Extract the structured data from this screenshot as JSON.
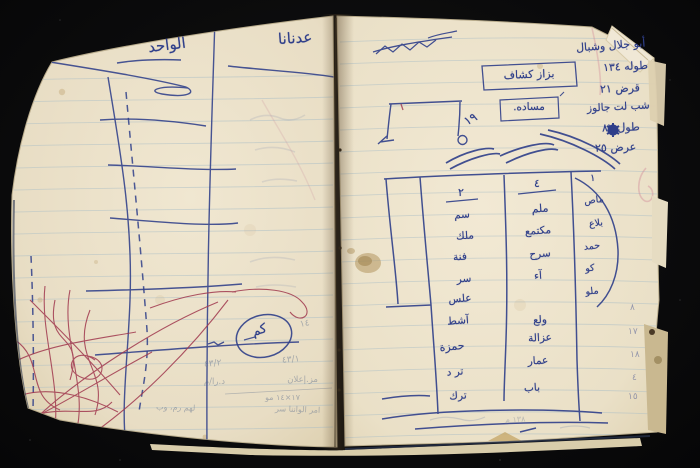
{
  "colors": {
    "background": "#0b0b0c",
    "paper_left": "#e9dfc8",
    "paper_right": "#ece3cc",
    "ruled_line": "#a9bdc6",
    "ink_blue": "#2f3f8a",
    "ink_red": "#a0384e",
    "pencil": "#64748f",
    "cover_edge": "#2a3550"
  },
  "left_page": {
    "header_right": "عدنانا",
    "header_left": "الواحد",
    "circled_word": "كم",
    "side_mark": "١٤",
    "pencil_notes": [
      "٤٣/٢",
      "٤٣/١",
      "د.را/م",
      "مز.إعلان",
      "١٧×١٤ مو",
      "امر الواننا سر",
      "لهم رم، وب"
    ]
  },
  "right_page": {
    "ink_notes": [
      "أبو جلال وشبال",
      "طوله ١٣٤",
      "قرض ٢١",
      "شب لت جالوز",
      "طول ٨٢",
      "عرض ٢٥"
    ],
    "boxed_labels": [
      "بزاز كشاف",
      "مساده."
    ],
    "sketch_number": "١٩",
    "table": {
      "col1_header": "٢",
      "col1_entries": [
        "سم",
        "ملك",
        "فنة",
        "سر",
        "علس",
        "آشط",
        "حمزة",
        "تر د",
        "ترك"
      ],
      "col2_header": "٤",
      "col2_entries": [
        "ملم",
        "مكتمع",
        "سرح",
        "آء",
        "ولع",
        "عزالة",
        "عمار",
        "باب"
      ],
      "col3_header": "١",
      "col3_entries": [
        "ماص",
        "بلاع",
        "حمد",
        "كو",
        "ملو"
      ]
    },
    "margin_numbers": [
      "٨",
      "١٧",
      "١٨",
      "٤",
      "١٥"
    ],
    "bottom_note": "١٣٨ م"
  }
}
